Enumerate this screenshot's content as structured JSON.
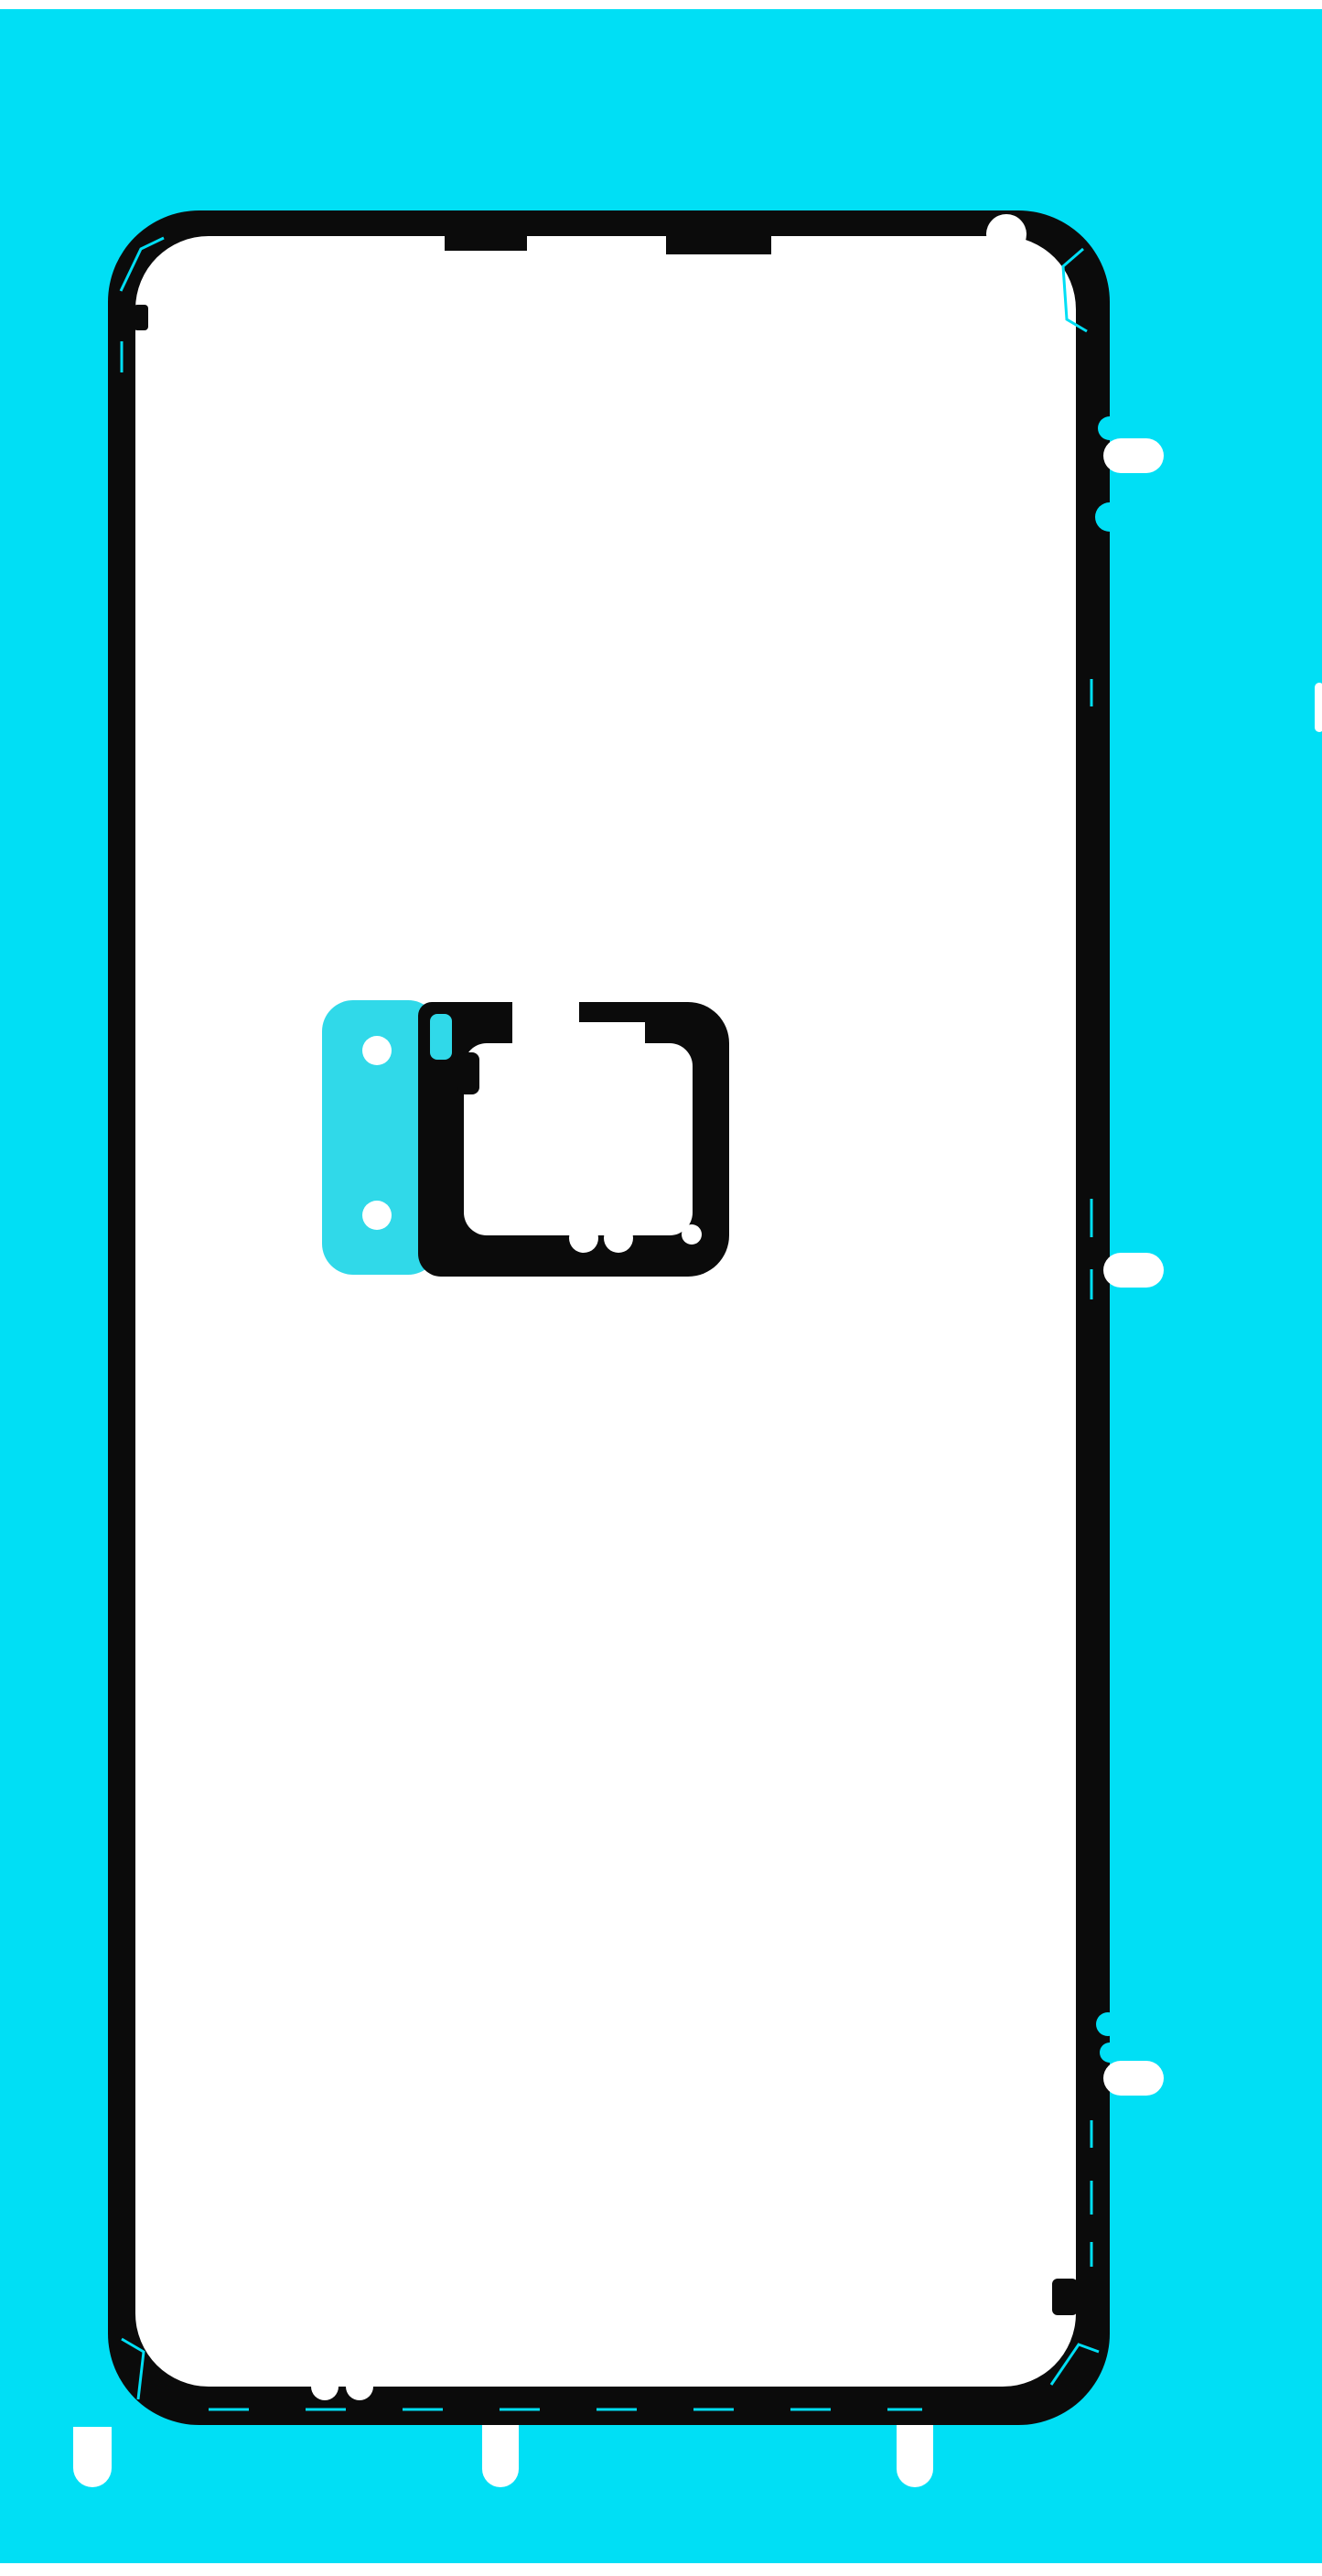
{
  "image": {
    "alt": "Product photo: die-cut adhesive sticker sheet for a smartphone back cover. A black adhesive gasket outline and a black camera-lens adhesive with a cyan liner pull tab sit on a bright cyan release liner over white backing.",
    "colors": {
      "page_white": "#ffffff",
      "liner_cyan": "#00dff5",
      "tab_cyan": "#30d9e9",
      "adhesive_black": "#0b0b0b"
    }
  }
}
